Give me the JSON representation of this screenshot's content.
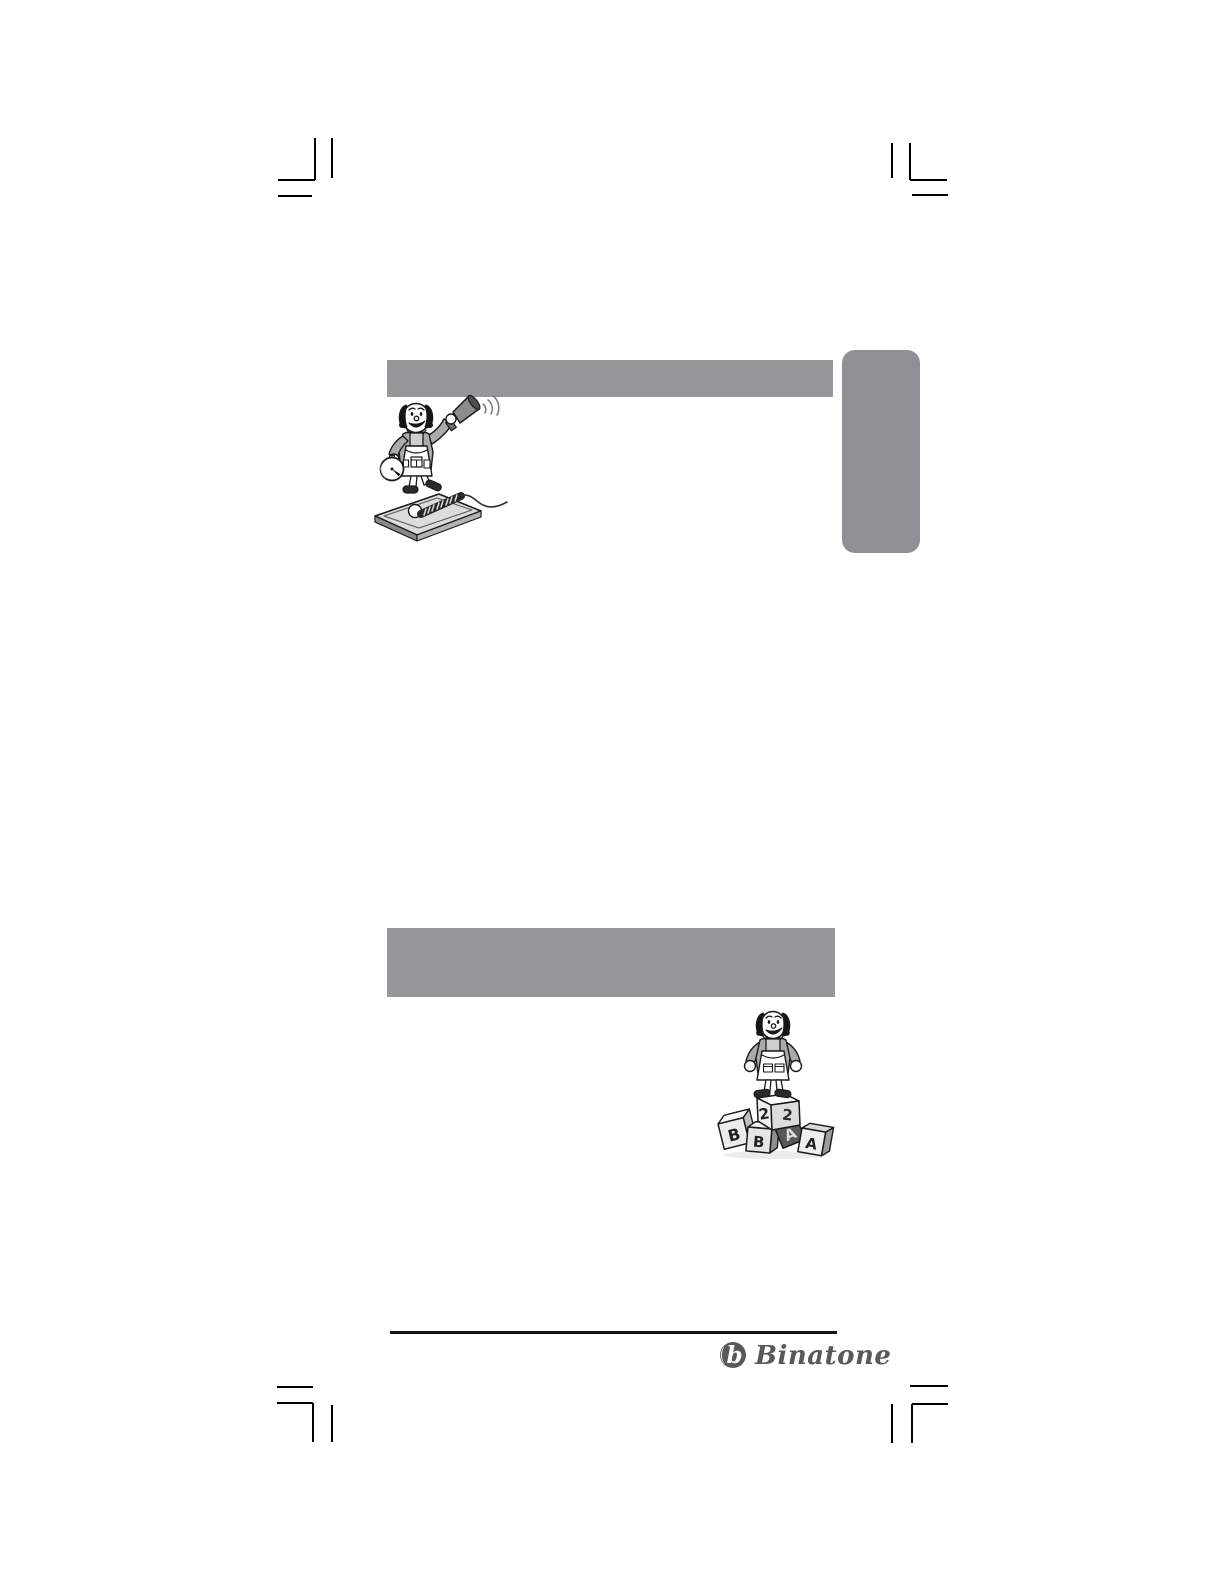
{
  "colors": {
    "page_background": "#ffffff",
    "section_bar": "#97979a",
    "side_tab": "#8f9094",
    "crop_marks": "#000000",
    "footer_rule": "#141414",
    "logo_gray": "#58595b",
    "cartoon_line": "#1a1a1a",
    "cartoon_shade": "#ababab"
  },
  "header_bars": [
    {
      "text": ""
    },
    {
      "text": ""
    }
  ],
  "side_tab": {
    "text": ""
  },
  "illustrations": {
    "announcer": {
      "icon": "man-with-megaphone-and-timer-beside-telephone-icon"
    },
    "blocks": {
      "icon": "man-standing-on-letter-blocks-icon",
      "block_letters": [
        "2",
        "2",
        "B",
        "B",
        "A",
        "A"
      ]
    }
  },
  "footer": {
    "brand_name": "Binatone",
    "logo_monogram": "b"
  }
}
